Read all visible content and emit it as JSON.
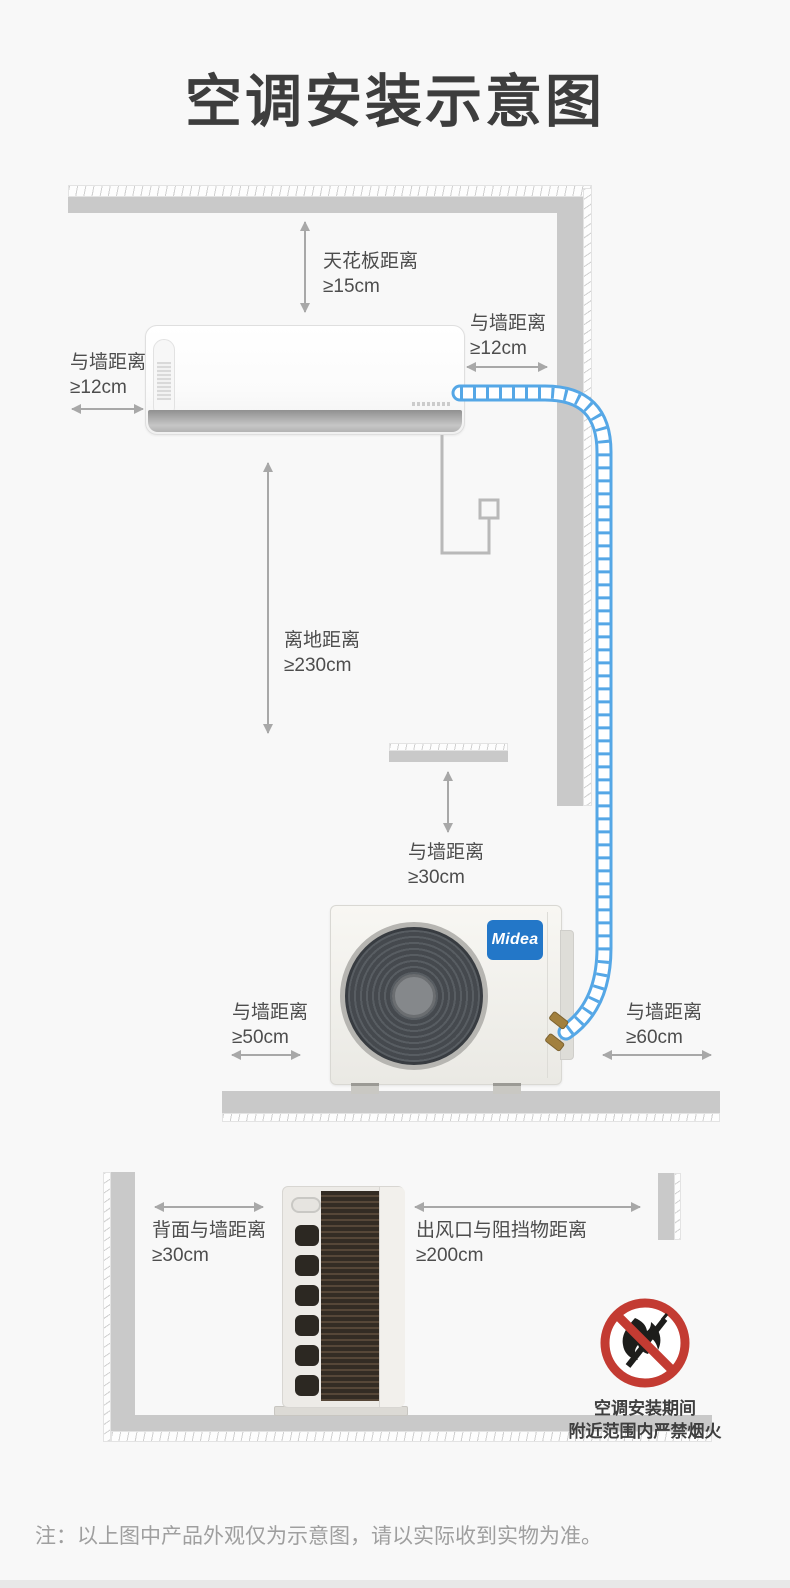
{
  "title": "空调安装示意图",
  "labels": {
    "ceiling": {
      "name": "天花板距离",
      "value": "≥15cm"
    },
    "indoor_left_wall": {
      "name": "与墙距离",
      "value": "≥12cm"
    },
    "indoor_right_wall": {
      "name": "与墙距离",
      "value": "≥12cm"
    },
    "floor_height": {
      "name": "离地距离",
      "value": "≥230cm"
    },
    "outdoor_top_wall": {
      "name": "与墙距离",
      "value": "≥30cm"
    },
    "outdoor_left_wall": {
      "name": "与墙距离",
      "value": "≥50cm"
    },
    "outdoor_right_wall": {
      "name": "与墙距离",
      "value": "≥60cm"
    },
    "outdoor_back_wall": {
      "name": "背面与墙距离",
      "value": "≥30cm"
    },
    "outdoor_outlet": {
      "name": "出风口与阻挡物距离",
      "value": "≥200cm"
    }
  },
  "brand": {
    "logo_text": "Midea"
  },
  "warning": {
    "line1": "空调安装期间",
    "line2": "附近范围内严禁烟火"
  },
  "note": "注：以上图中产品外观仅为示意图，请以实际收到实物为准。",
  "colors": {
    "pipe_blue": "#55a7e6",
    "brand_blue": "#2377c8",
    "warning_red": "#c33b32",
    "wall_gray": "#c9c9c9",
    "arrow_gray": "#a8a8a8",
    "title_gray": "#3d3d3d",
    "label_gray": "#4d4d4d",
    "background": "#f8f8f8"
  }
}
